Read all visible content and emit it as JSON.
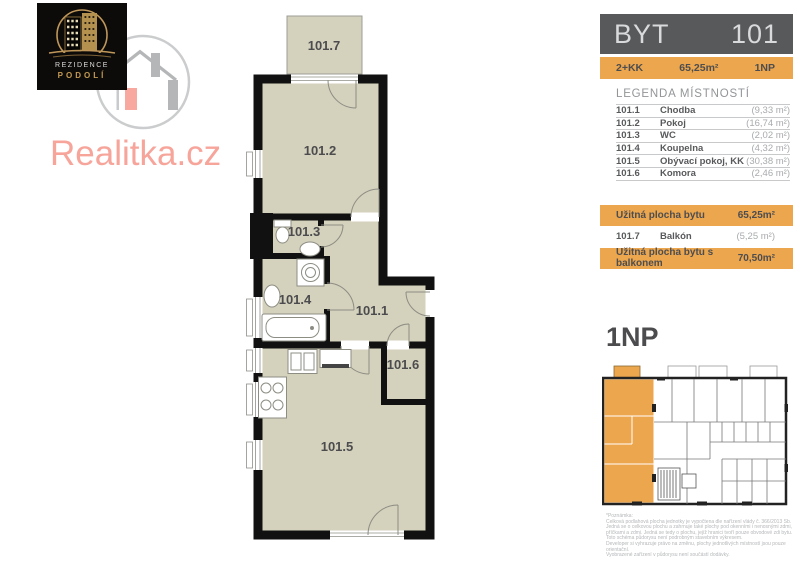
{
  "brand": {
    "site": "Realitka.cz",
    "logo_line1": "REZIDENCE",
    "logo_line2": "PODOLÍ"
  },
  "header": {
    "left": "BYT",
    "right": "101",
    "disposition": "2+KK",
    "area": "65,25m²",
    "floor": "1NP"
  },
  "legend": {
    "heading": "LEGENDA MÍSTNOSTÍ",
    "rooms": [
      {
        "num": "101.1",
        "name": "Chodba",
        "area": "(9,33 m²)"
      },
      {
        "num": "101.2",
        "name": "Pokoj",
        "area": "(16,74 m²)"
      },
      {
        "num": "101.3",
        "name": "WC",
        "area": "(2,02 m²)"
      },
      {
        "num": "101.4",
        "name": "Koupelna",
        "area": "(4,32 m²)"
      },
      {
        "num": "101.5",
        "name": "Obývací pokoj, KK",
        "area": "(30,38 m²)"
      },
      {
        "num": "101.6",
        "name": "Komora",
        "area": "(2,46 m²)"
      }
    ]
  },
  "summary": {
    "usable_label": "Užitná plocha bytu",
    "usable_value": "65,25m²",
    "balcony_num": "101.7",
    "balcony_name": "Balkón",
    "balcony_area": "(5,25 m²)",
    "total_label": "Užitná plocha bytu s balkonem",
    "total_value": "70,50m²"
  },
  "floor_plan": {
    "heading": "1NP",
    "labels": [
      "101.7",
      "101.2",
      "101.3",
      "101.4",
      "101.1",
      "101.6",
      "101.5"
    ]
  },
  "disclaimer": {
    "lines": [
      "*Poznámka:",
      "Celková podlahová plocha jednotky je vypočtena dle nařízení vlády č. 366/2013 Sb.",
      "Jedná se o celkovou plochu a zahrnuje také plochy pod okenními i nenosnými zdmi,",
      "příčkami a zdmi. Jedná se tedy o plochu, jejíž hranici tvoří pouze obvodové zdi bytu.",
      "Toto schéma půdorysu není podrobným stavebním výkresem.",
      "Developer si vyhrazuje právo na změnu, plochy jednotlivých místností jsou pouze orientační.",
      "Vyobrazené zařízení v půdorysu není součástí dodávky."
    ]
  },
  "colors": {
    "accent_orange": "#eca64e",
    "bar_gray": "#58595b",
    "floor_beige": "#d4d1bc",
    "wall_black": "#111111",
    "brand_pink": "#f7a59b",
    "logo_gold": "#c0975a",
    "muted_gray": "#a8aaad"
  }
}
